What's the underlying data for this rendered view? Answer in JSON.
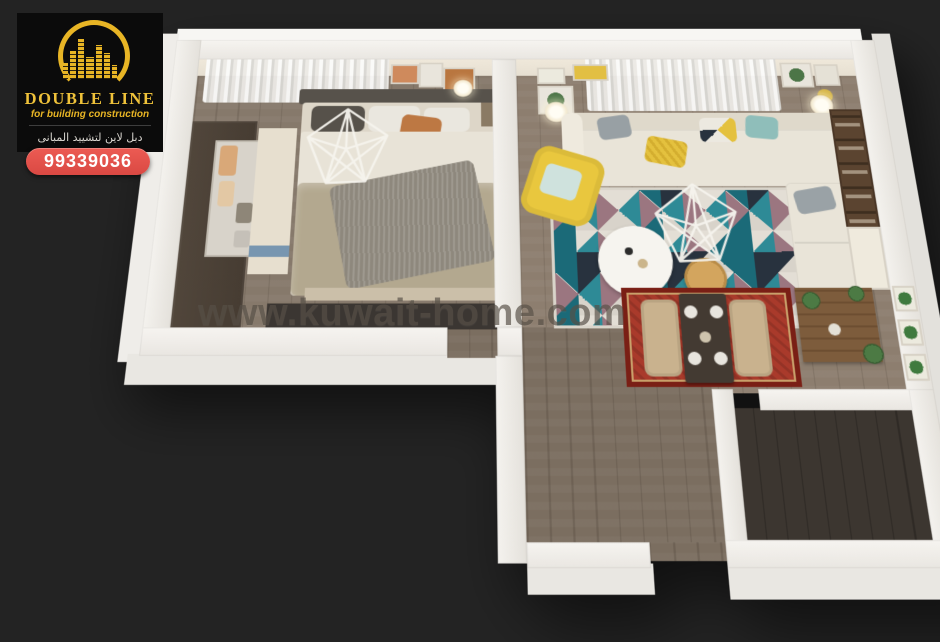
{
  "background": "#232323",
  "logo": {
    "title": "DOUBLE LINE",
    "subtitle": "for building construction",
    "arabic_line": "دبل لاين لتشييد المبانى",
    "phone": "99339036",
    "gold": "#e8b525",
    "panel_black": "#0b0b0b",
    "badge_red": "#e2514b"
  },
  "watermark": {
    "text": "www.kuwait-home.com",
    "color": "#575047"
  },
  "icons": {
    "logo_mark": "building-skyline-arc-icon",
    "pendant_light": "geometric-wireframe-pendant-icon"
  },
  "scene": {
    "type": "isometric-3d-floor-plan-render",
    "rooms": [
      "bedroom",
      "living-room",
      "dining-area",
      "hallway",
      "empty-room"
    ]
  },
  "palette": {
    "wall": "#f3f1ed",
    "floor_wood": "#86796b",
    "floor_dark": "#3c3630",
    "sofa_cream": "#e9e4d8",
    "armchair_yellow": "#e9c73e",
    "rug_teal": "#2e8a96",
    "rug_teal_dark": "#1b6a78",
    "rug_mauve": "#9b7680",
    "rug_navy": "#28323e",
    "dining_rug_red": "#a93a2b",
    "wood_furniture": "#5b4430",
    "bed_khaki": "#b3a88f"
  }
}
